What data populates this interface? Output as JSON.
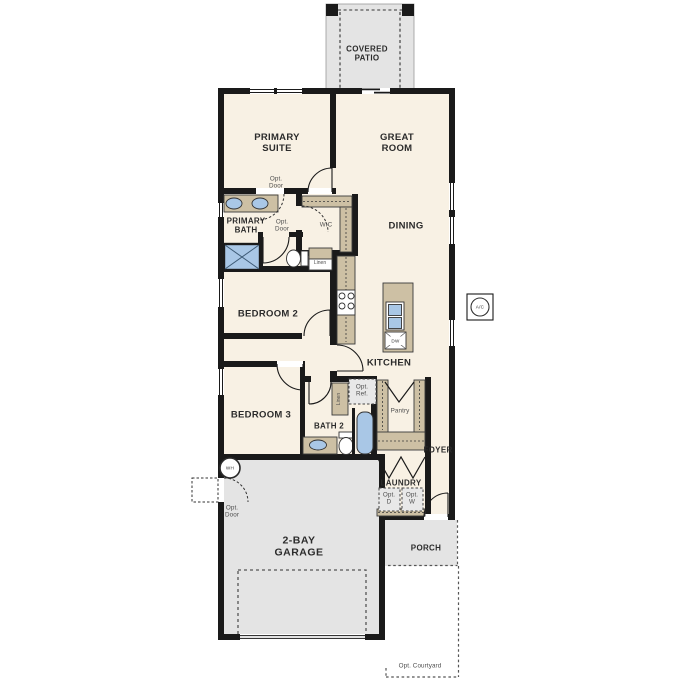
{
  "labels": {
    "covered_patio": "COVERED\nPATIO",
    "primary_suite": "PRIMARY\nSUITE",
    "great_room": "GREAT\nROOM",
    "dining": "DINING",
    "primary_bath": "PRIMARY\nBATH",
    "wic": "WIC",
    "opt_door_suite": "Opt.\nDoor",
    "opt_door_wic": "Opt.\nDoor",
    "opt_door_garage": "Opt.\nDoor",
    "linen_hall": "Linen",
    "linen_bath2": "Linen",
    "bedroom_2": "BEDROOM 2",
    "bedroom_3": "BEDROOM 3",
    "kitchen": "KITCHEN",
    "bath_2": "BATH 2",
    "opt_ref": "Opt.\nRef.",
    "pantry": "Pantry",
    "foyer": "FOYER",
    "laundry": "LAUNDRY",
    "opt_dryer": "Opt.\nD",
    "opt_washer": "Opt.\nW",
    "garage": "2-BAY\nGARAGE",
    "porch": "PORCH",
    "opt_courtyard": "Opt. Courtyard",
    "water_heater": "WH",
    "ac_unit": "A/C",
    "dishwasher": "DW"
  },
  "colors": {
    "wall": "#1a1a1a",
    "floor": "#f8f1e4",
    "outdoor": "#e4e4e4",
    "cabinet": "#cdc0a4",
    "fixture": "#a9c7e6",
    "label_dark": "#2b2b2b",
    "label_gray": "#4e4e4e"
  }
}
